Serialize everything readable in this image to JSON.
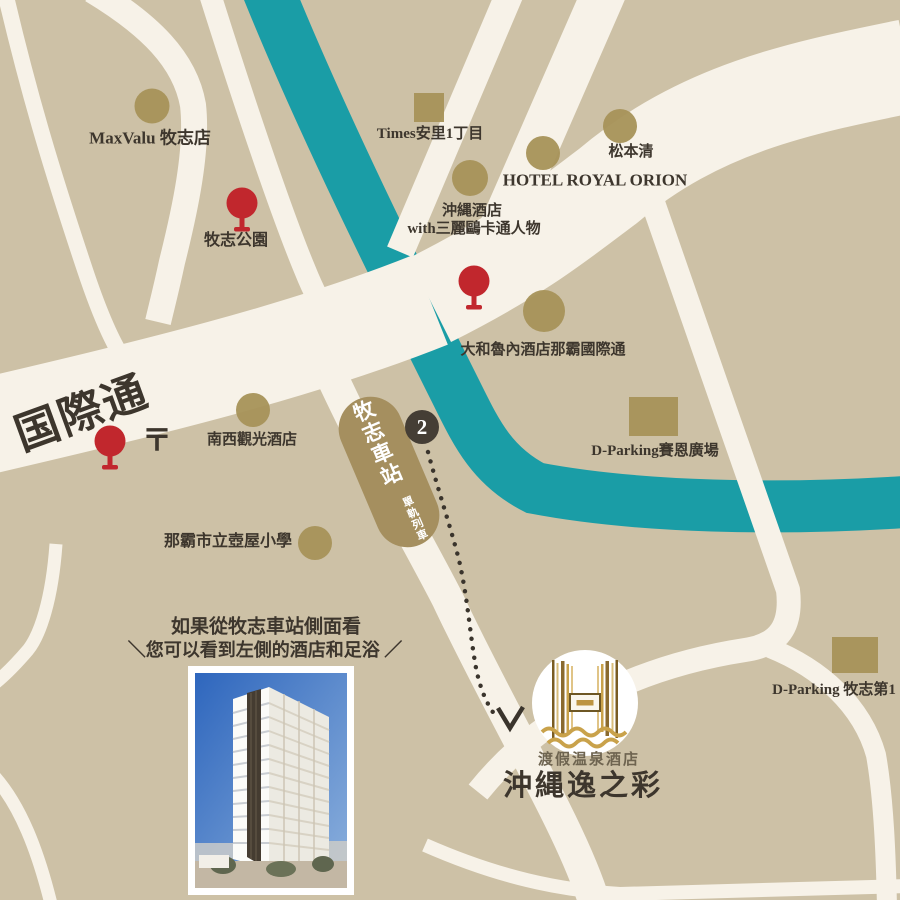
{
  "map": {
    "pois": {
      "maxvalu": "MaxValu 牧志店",
      "times_parking": "Times安里1丁目",
      "matsumotokiyoshi": "松本清",
      "hotel_royal_orion": "HOTEL ROYAL ORION",
      "okinawa_hotel_line1": "沖縄酒店",
      "okinawa_hotel_line2": "with三麗鷗卡通人物",
      "makishi_park": "牧志公園",
      "daiwa_roynet": "大和魯內酒店那霸國際通",
      "kokusai_dori": "国際通",
      "postal_mark": "〒",
      "nansei_kanko_hotel": "南西觀光酒店",
      "dparking_saion": "D-Parking賽恩廣場",
      "tsuboya_school": "那霸市立壺屋小學",
      "dparking_makishi_no1": "D-Parking 牧志第1"
    },
    "station": {
      "name": "牧志車站",
      "line": "單軌列車",
      "exit_number": "2"
    },
    "hotel": {
      "tagline": "渡假温泉酒店",
      "name": "沖縄逸之彩"
    },
    "caption": {
      "line1": "如果從牧志車站側面看",
      "line2": "＼您可以看到左側的酒店和足浴 ／"
    },
    "colors": {
      "block_tan": "#cdc1a6",
      "road_cream": "#f7f2e8",
      "river_teal": "#1a9da6",
      "building_brown": "#a69258",
      "pin_red": "#c1272d",
      "badge_dark": "#453e35",
      "label_dark": "#3d362d",
      "logo_gold": "#c9a24b",
      "station_brown": "#a58f5f",
      "photo_sky_blue": "#2e66bd"
    }
  }
}
